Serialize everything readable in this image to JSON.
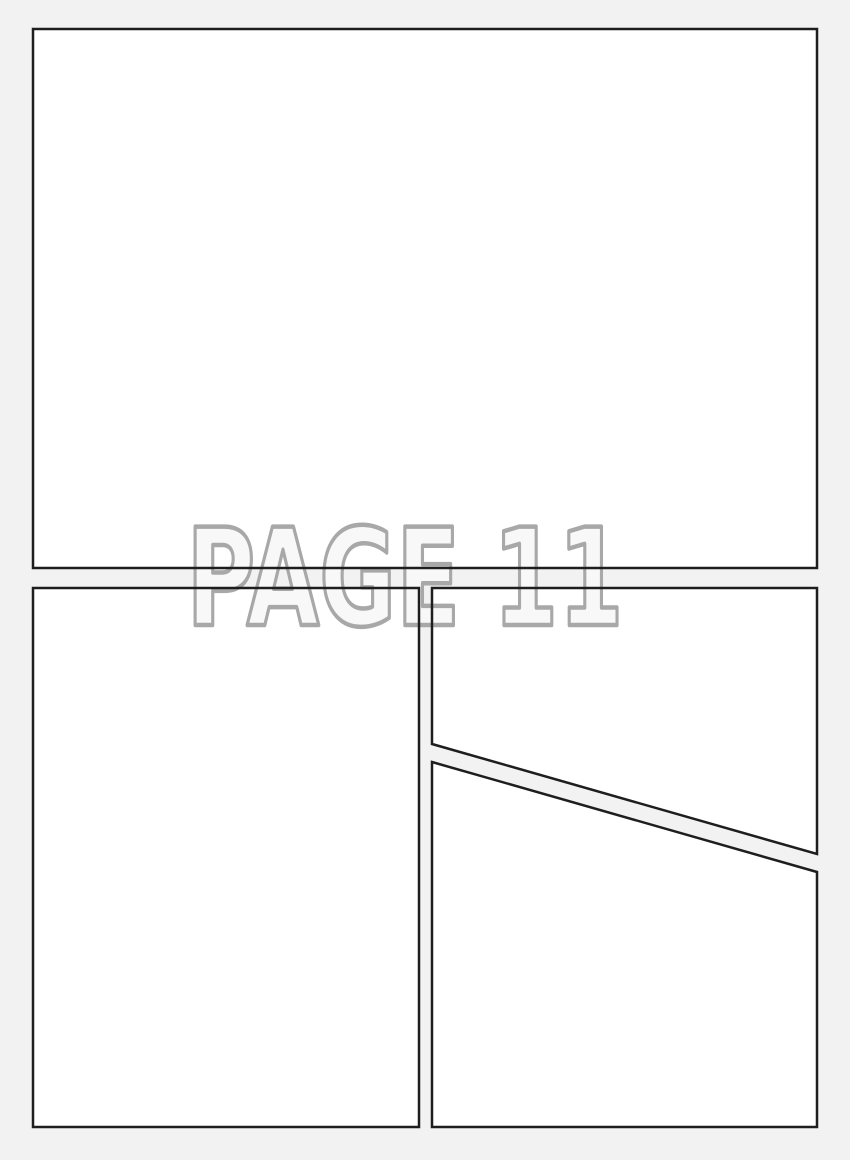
{
  "page": {
    "label": "PAGE 11"
  },
  "colors": {
    "background": "#f2f2f2",
    "panel_fill": "#ffffff",
    "panel_border": "#1e1e1e",
    "label_fill": "#f8f8f8",
    "label_outline": "#a8a8a8"
  }
}
